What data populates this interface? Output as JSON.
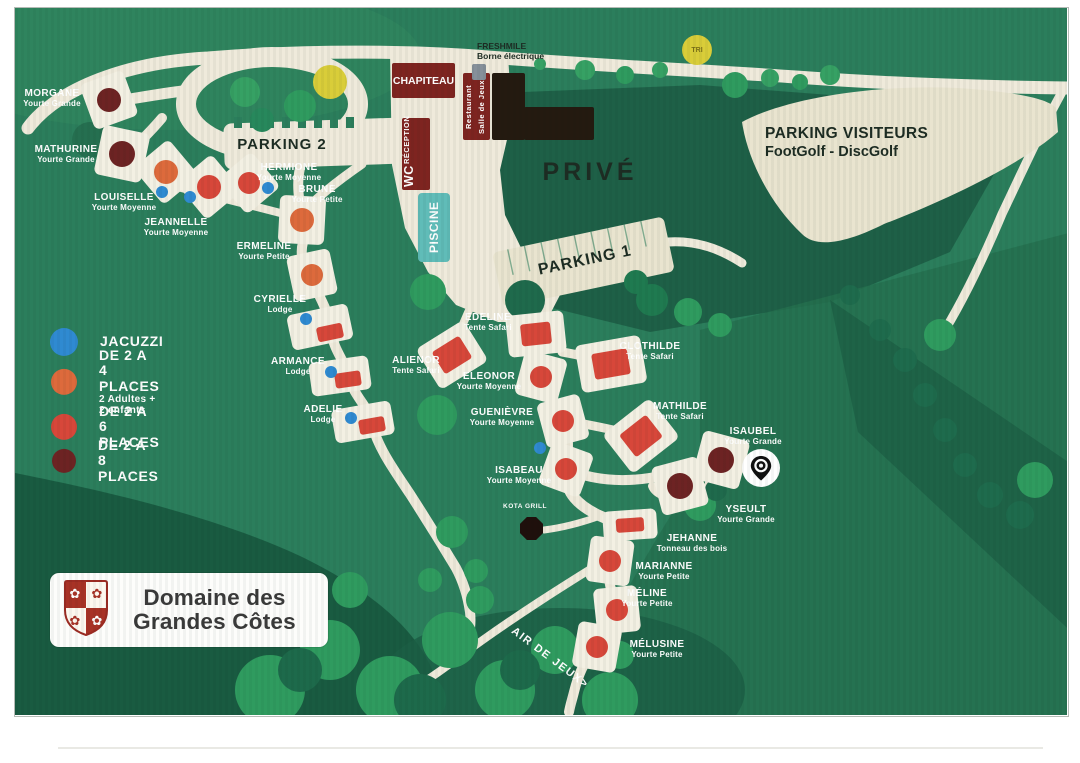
{
  "colors": {
    "map_green": "#2b7e5c",
    "dark_green": "#1e6047",
    "forest": "#195b41",
    "tree": "#2f9b5f",
    "road": "#efeadb",
    "parking": "#e9e4cf",
    "building_red": "#7e2420",
    "building_dark": "#241a10",
    "pool": "#60bcb8",
    "yellow": "#d9cd39",
    "p4": "#dd6a3c",
    "p6": "#d7473a",
    "p8": "#6d2323",
    "jacuzzi": "#2f8ad1",
    "tent": "#d7473a"
  },
  "logo": {
    "line1": "Domaine des",
    "line2": "Grandes Côtes"
  },
  "labels": {
    "parking1": "PARKING 1",
    "parking2": "PARKING 2",
    "parking_visiteurs": "PARKING VISITEURS",
    "parking_visiteurs_sub": "FootGolf - DiscGolf",
    "prive": "PRIVÉ",
    "freshmile": "FRESHMILE",
    "freshmile_sub": "Borne électrique",
    "chapiteau": "CHAPITEAU",
    "restaurant_line1": "Restaurant",
    "restaurant_line2": "Salle de Jeux",
    "reception": "RÉCEPTION",
    "wc": "WC",
    "piscine": "PISCINE",
    "tri": "TRI",
    "kota_grill": "KOTA GRILL",
    "air_de_jeux": "AIR DE JEUX>"
  },
  "legend": {
    "items": [
      {
        "label": "JACUZZI",
        "sub": "",
        "color_key": "jacuzzi",
        "y": 342,
        "r": 14
      },
      {
        "label": "DE 2 A 4 PLACES",
        "sub": "2 Adultes + 2 enfants",
        "color_key": "p4",
        "y": 382,
        "r": 13
      },
      {
        "label": "DE 2 A 6 PLACES",
        "sub": "",
        "color_key": "p6",
        "y": 427,
        "r": 13
      },
      {
        "label": "DE 2 A 8 PLACES",
        "sub": "",
        "color_key": "p8",
        "y": 461,
        "r": 12
      }
    ]
  },
  "sites": [
    {
      "name": "MORGANE",
      "type": "Yourte Grande",
      "shape": "circle",
      "color": "p8",
      "x": 109,
      "y": 100,
      "r": 12,
      "rot": -20,
      "lx": 52,
      "ly": 88
    },
    {
      "name": "MATHURINE",
      "type": "Yourte Grande",
      "shape": "circle",
      "color": "p8",
      "x": 122,
      "y": 154,
      "r": 13,
      "rot": 12,
      "lx": 66,
      "ly": 144
    },
    {
      "name": "LOUISELLE",
      "type": "Yourte Moyenne",
      "shape": "circle",
      "color": "p4",
      "x": 166,
      "y": 172,
      "r": 12,
      "rot": -40,
      "lx": 124,
      "ly": 192,
      "jx": 162,
      "jy": 192
    },
    {
      "name": "JEANNELLE",
      "type": "Yourte Moyenne",
      "shape": "circle",
      "color": "p6",
      "x": 209,
      "y": 187,
      "r": 12,
      "rot": -40,
      "lx": 176,
      "ly": 217,
      "jx": 190,
      "jy": 197
    },
    {
      "name": "HERMIONE",
      "type": "Yourte Moyenne",
      "shape": "circle",
      "color": "p6",
      "x": 249,
      "y": 183,
      "r": 11,
      "rot": -40,
      "lx": 289,
      "ly": 162,
      "jx": 268,
      "jy": 188
    },
    {
      "name": "BRUNE",
      "type": "Yourte Petite",
      "shape": "circle",
      "color": "p4",
      "x": 302,
      "y": 220,
      "r": 12,
      "rot": 3,
      "lx": 317,
      "ly": 184
    },
    {
      "name": "ERMELINE",
      "type": "Yourte Petite",
      "shape": "circle",
      "color": "p4",
      "x": 312,
      "y": 275,
      "r": 11,
      "rot": -12,
      "lx": 264,
      "ly": 241
    },
    {
      "name": "CYRIELLE",
      "type": "Lodge",
      "shape": "rect",
      "color": "p6",
      "x": 330,
      "y": 332,
      "w": 26,
      "h": 15,
      "rot": -12,
      "pcx": 320,
      "pcy": 327,
      "pw": 62,
      "ph": 36,
      "lx": 280,
      "ly": 294,
      "jx": 306,
      "jy": 319
    },
    {
      "name": "ARMANCE",
      "type": "Lodge",
      "shape": "rect",
      "color": "p6",
      "x": 348,
      "y": 379,
      "w": 26,
      "h": 15,
      "rot": -8,
      "pcx": 340,
      "pcy": 376,
      "pw": 60,
      "ph": 34,
      "lx": 298,
      "ly": 356,
      "jx": 331,
      "jy": 372
    },
    {
      "name": "ADELIE",
      "type": "Lodge",
      "shape": "rect",
      "color": "p6",
      "x": 372,
      "y": 425,
      "w": 26,
      "h": 15,
      "rot": -10,
      "pcx": 363,
      "pcy": 422,
      "pw": 60,
      "ph": 34,
      "lx": 323,
      "ly": 404,
      "jx": 351,
      "jy": 418
    },
    {
      "name": "ALIENOR",
      "type": "Tente Safari",
      "shape": "rect",
      "color": "tent",
      "x": 452,
      "y": 355,
      "w": 32,
      "h": 26,
      "rot": -32,
      "pw": 56,
      "ph": 48,
      "lx": 416,
      "ly": 355
    },
    {
      "name": "EDELINE",
      "type": "Tente Safari",
      "shape": "rect",
      "color": "tent",
      "x": 536,
      "y": 334,
      "w": 30,
      "h": 22,
      "rot": -6,
      "pw": 58,
      "ph": 42,
      "lx": 488,
      "ly": 312
    },
    {
      "name": "ELEONOR",
      "type": "Yourte Moyenne",
      "shape": "circle",
      "color": "p6",
      "x": 541,
      "y": 377,
      "r": 11,
      "rot": 15,
      "lx": 489,
      "ly": 371
    },
    {
      "name": "CLOTHILDE",
      "type": "Tente Safari",
      "shape": "rect",
      "color": "tent",
      "x": 611,
      "y": 364,
      "w": 36,
      "h": 26,
      "rot": -10,
      "pw": 66,
      "ph": 48,
      "lx": 650,
      "ly": 341
    },
    {
      "name": "GUENIÈVRE",
      "type": "Yourte Moyenne",
      "shape": "circle",
      "color": "p6",
      "x": 563,
      "y": 421,
      "r": 11,
      "rot": -15,
      "lx": 502,
      "ly": 407
    },
    {
      "name": "MATHILDE",
      "type": "Tente Safari",
      "shape": "rect",
      "color": "tent",
      "x": 641,
      "y": 436,
      "w": 34,
      "h": 28,
      "rot": -38,
      "pw": 60,
      "ph": 50,
      "lx": 680,
      "ly": 401
    },
    {
      "name": "ISABEAU",
      "type": "Yourte Moyenne",
      "shape": "circle",
      "color": "p6",
      "x": 566,
      "y": 469,
      "r": 11,
      "rot": 20,
      "lx": 519,
      "ly": 465,
      "jx": 540,
      "jy": 448
    },
    {
      "name": "ISAUBEL",
      "type": "Yourte Grande",
      "shape": "circle",
      "color": "p8",
      "x": 721,
      "y": 460,
      "r": 13,
      "rot": 15,
      "lx": 753,
      "ly": 426
    },
    {
      "name": "YSEULT",
      "type": "Yourte Grande",
      "shape": "circle",
      "color": "p8",
      "x": 680,
      "y": 486,
      "r": 13,
      "rot": -15,
      "lx": 746,
      "ly": 504
    },
    {
      "name": "JEHANNE",
      "type": "Tonneau des bois",
      "shape": "rect",
      "color": "p6",
      "x": 630,
      "y": 525,
      "w": 28,
      "h": 14,
      "rot": -4,
      "pw": 54,
      "ph": 30,
      "lx": 692,
      "ly": 533
    },
    {
      "name": "MARIANNE",
      "type": "Yourte Petite",
      "shape": "circle",
      "color": "p6",
      "x": 610,
      "y": 561,
      "r": 11,
      "rot": 8,
      "lx": 664,
      "ly": 561
    },
    {
      "name": "MÉLINE",
      "type": "Yourte Petite",
      "shape": "circle",
      "color": "p6",
      "x": 617,
      "y": 610,
      "r": 11,
      "rot": -6,
      "lx": 647,
      "ly": 588
    },
    {
      "name": "MÉLUSINE",
      "type": "Yourte Petite",
      "shape": "circle",
      "color": "p6",
      "x": 597,
      "y": 647,
      "r": 11,
      "rot": 10,
      "lx": 657,
      "ly": 639
    }
  ]
}
